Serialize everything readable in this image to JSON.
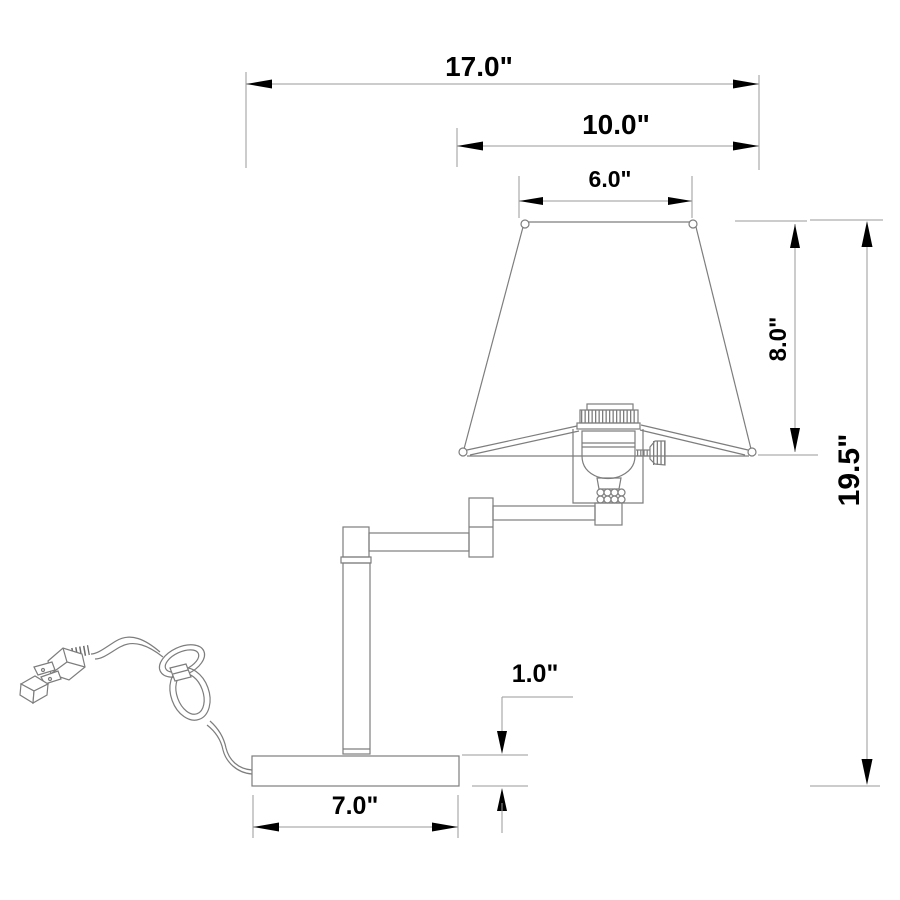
{
  "diagram": {
    "type": "technical-dimension-drawing",
    "subject": "Swing-arm table lamp with shade, pole, base and power cord",
    "unit": "inches",
    "background_color": "#ffffff",
    "drawing_line_color": "#7d7d7d",
    "dimension_line_color": "#9a9a9a",
    "text_color": "#000000",
    "dimensions": [
      {
        "id": "overall-width",
        "label": "17.0\"",
        "value": 17.0,
        "orientation": "horizontal"
      },
      {
        "id": "shade-bottom-width",
        "label": "10.0\"",
        "value": 10.0,
        "orientation": "horizontal"
      },
      {
        "id": "shade-top-width",
        "label": "6.0\"",
        "value": 6.0,
        "orientation": "horizontal"
      },
      {
        "id": "shade-height",
        "label": "8.0\"",
        "value": 8.0,
        "orientation": "vertical"
      },
      {
        "id": "overall-height",
        "label": "19.5\"",
        "value": 19.5,
        "orientation": "vertical"
      },
      {
        "id": "base-height",
        "label": "1.0\"",
        "value": 1.0,
        "orientation": "vertical"
      },
      {
        "id": "base-width",
        "label": "7.0\"",
        "value": 7.0,
        "orientation": "horizontal"
      }
    ]
  }
}
